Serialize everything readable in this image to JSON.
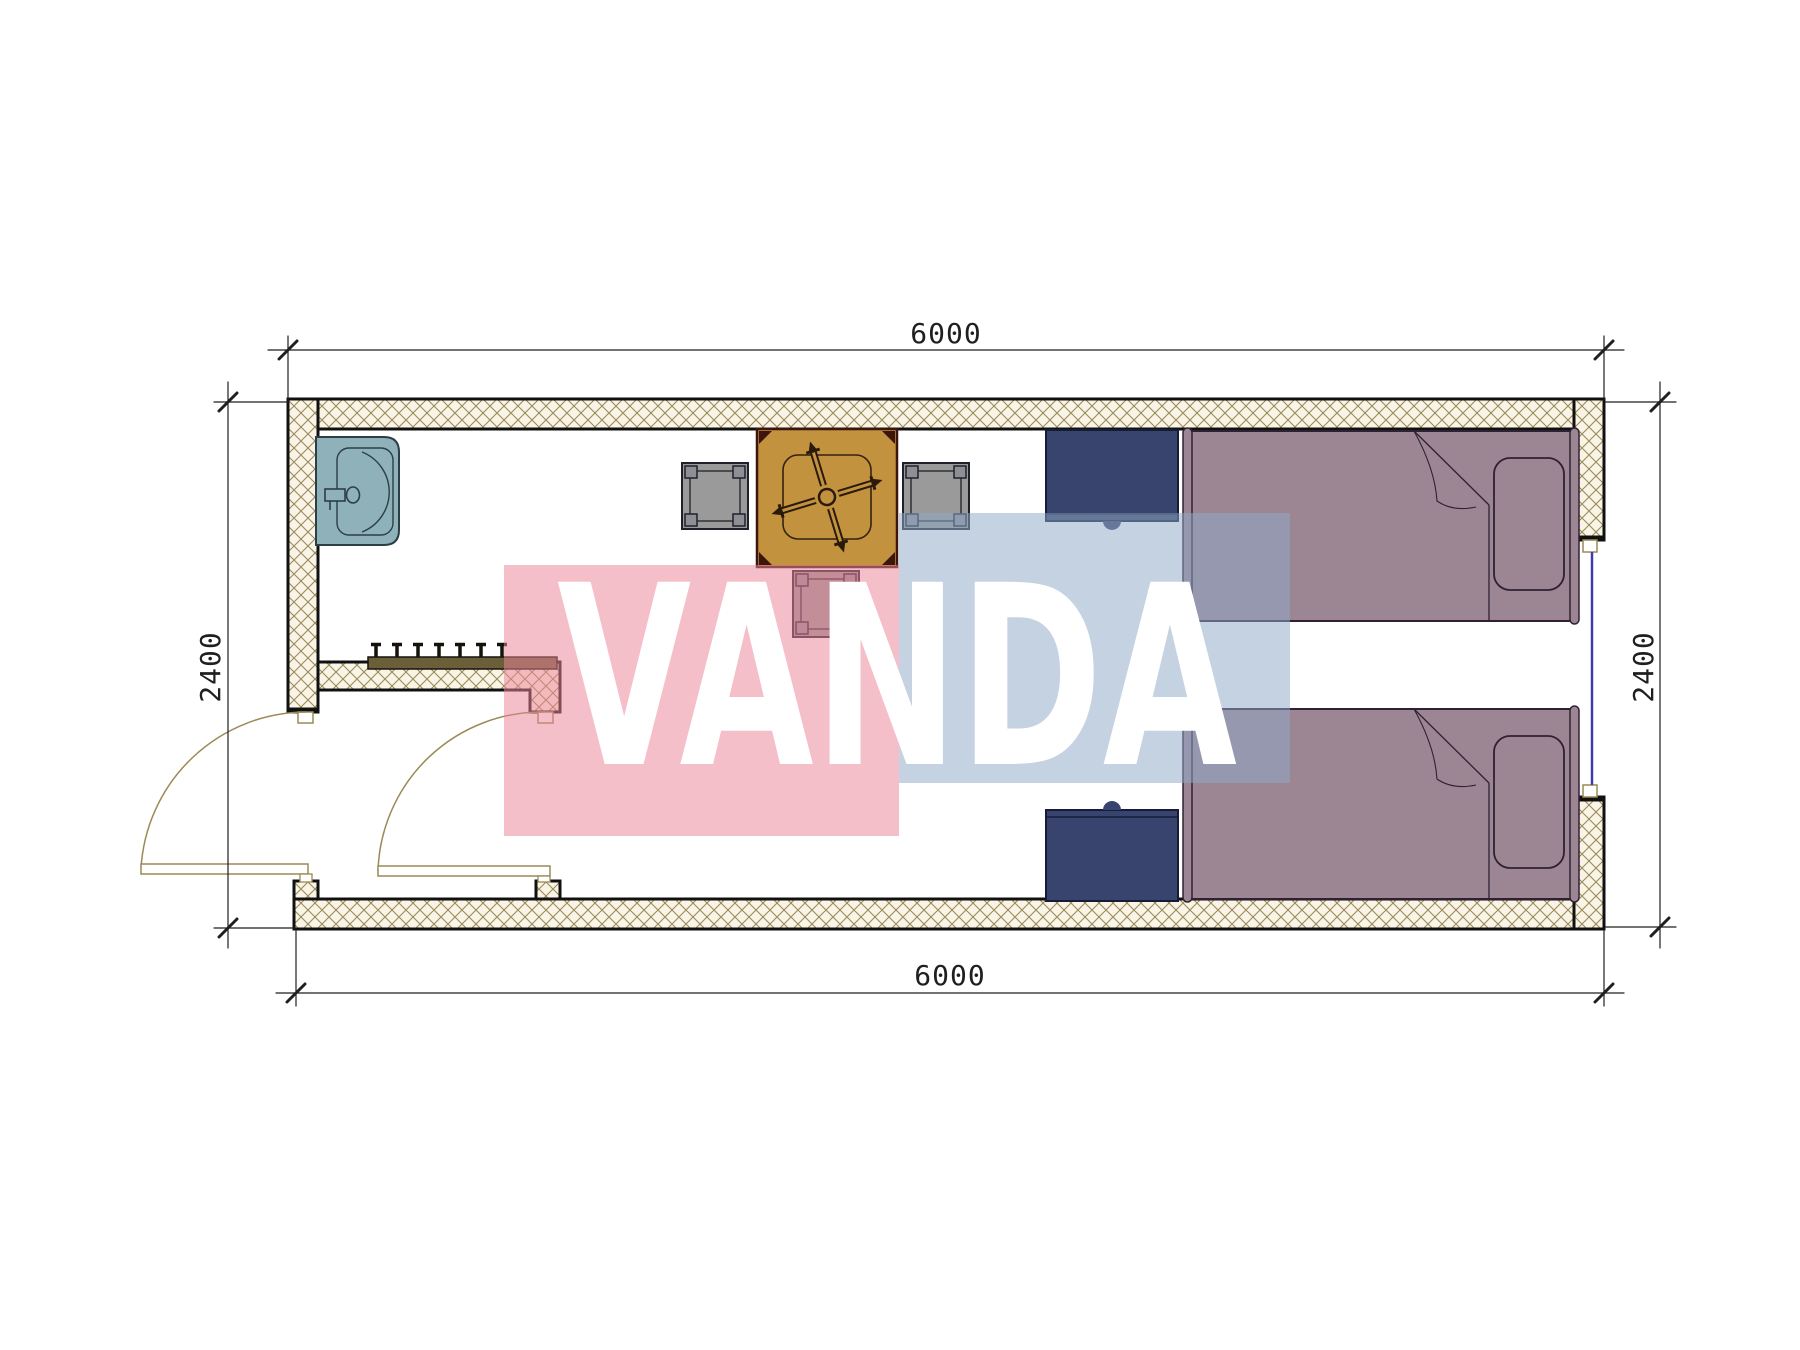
{
  "page_title": "Container cabin floor plan drawing",
  "dimensions": {
    "top": "6000",
    "bottom": "6000",
    "left": "2400",
    "right": "2400"
  },
  "watermark": {
    "text": "VANDA",
    "pink_block": "#F2A9B8",
    "blue_block": "#AFC3DA"
  },
  "walls": {
    "hatch_line_color": "#9A8A58",
    "hatch_background": "#FAF4E6",
    "outline_color": "#111111"
  },
  "furniture": [
    {
      "name": "sink",
      "color": "#8FB2BA",
      "count": 1
    },
    {
      "name": "coat-rack-hooks",
      "color": "#6B5F3A",
      "count": 1
    },
    {
      "name": "dining-table",
      "color": "#C2923E",
      "count": 1
    },
    {
      "name": "chair",
      "color": "#9A9A9A",
      "count": 3
    },
    {
      "name": "nightstand",
      "color": "#38436E",
      "count": 2
    },
    {
      "name": "single-bed",
      "color": "#9C8694",
      "count": 2
    },
    {
      "name": "window",
      "color": "#3D3DAE",
      "count": 1
    },
    {
      "name": "swing-door",
      "color": "#9B8A55",
      "count": 2
    }
  ]
}
